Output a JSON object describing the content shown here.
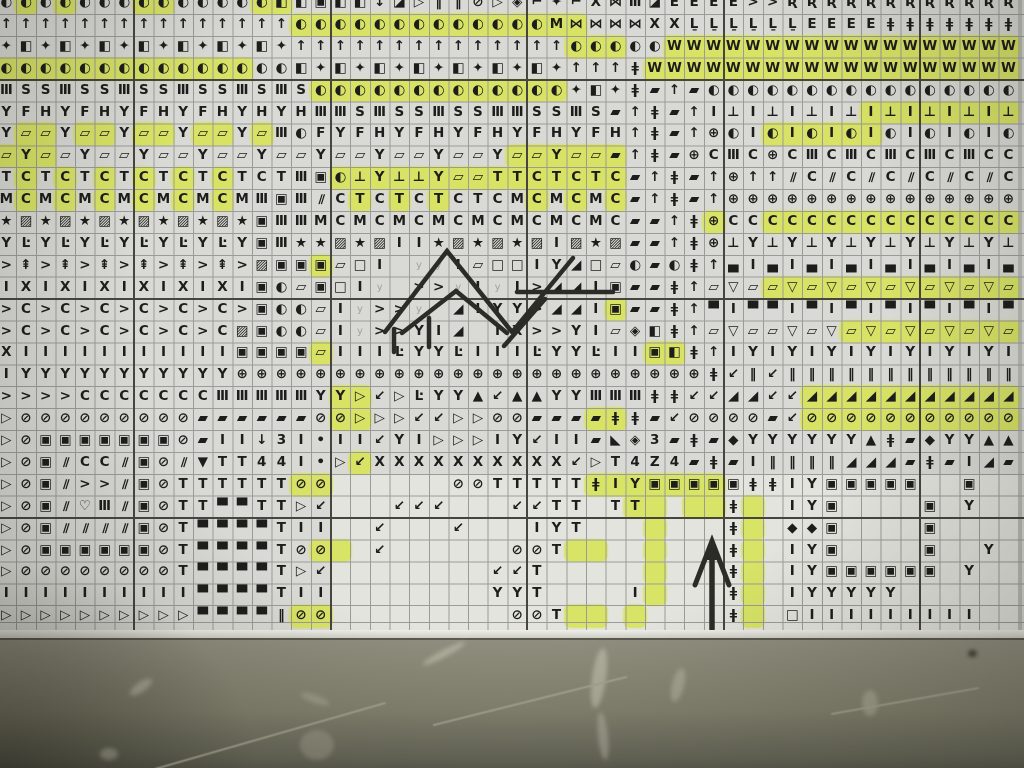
{
  "scene": {
    "description": "Photograph of a printed cross-stitch symbol chart with yellow highlighter marks, hand-drawn pen chevrons and a hand-drawn up arrow; gray wall below the paper edge"
  },
  "colors": {
    "paper": "#d9d9d5",
    "blank_paper": "#e4e4df",
    "thin_grid": "#9b9b97",
    "heavy_grid": "#46453f",
    "symbol_ink": "#1d1d1b",
    "highlighter": "#d8e45c",
    "pen_ink": "#2b2b27",
    "wall": "#83826f"
  },
  "symbol_legend": {
    "◐": "half-moon-circle-icon",
    "↑": "up-arrow-icon",
    "✦": "four-point-star-icon",
    "◧": "half-filled-square-icon",
    "▣": "square-in-square-icon",
    "◪": "diagonal-half-square-icon",
    "▱": "parallelogram-outline-icon",
    "▰": "parallelogram-filled-icon",
    "⊕": "circle-cross-icon",
    "⊘": "circle-slash-icon",
    "⊥": "tack-icon",
    "‖": "double-bar-icon",
    "★": "star-icon",
    "▨": "square-diagonal-icon",
    "Ŀ": "corner-dot-icon",
    "⇞": "barred-arrow-icon",
    "◈": "diamond-in-diamond-icon",
    "⌐": "flag-icon",
    "⋈": "bowtie-icon",
    "ǂ": "double-dagger-icon",
    "▽": "triangle-down-icon",
    "▷": "triangle-right-icon",
    "▲": "triangle-up-icon",
    "▀": "top-block-square-icon",
    "▄": "bottom-block-square-icon",
    "◢": "black-bean-diagonal-icon",
    "↙": "down-left-arrow-icon",
    "♡": "heart-icon",
    "◆": "black-diamond-icon",
    "∕∕": "double-slash-icon",
    "•": "dot-icon",
    "◣": "corner-triangle-icon"
  },
  "grid": {
    "cols": 52,
    "rows": 29,
    "cell_w": 19.65,
    "cell_h": 21.9,
    "origin_x": -3.5,
    "origin_y": -8,
    "heavy_cols": [
      7,
      17,
      27,
      37,
      47
    ],
    "heavy_rows": [
      4,
      14,
      24
    ],
    "rows_symbols": [
      "◐ ◐ ◐ ◐ ◐ ◐ ◐ ◐ ◐ ◐ ◐ ◐ ◐ ◐ ◧ ◧ ▣ ◧ ◧ ↓ ◪ ▷ ‖ ‖ ⊘ ▷ ◈ ⌐ ✦ ⌐ X ⋈ Ⅲ ◪ E E E E > > Ʀ Ʀ Ʀ Ʀ Ʀ Ʀ Ʀ Ʀ Ʀ Ʀ Ʀ Ʀ",
      "↑ ↑ ↑ ↑ ↑ ↑ ↑ ↑ ↑ ↑ ↑ ↑ ↑ ↑ ↑ ◐ ◐ ◐ ◐ ◐ ◐ ◐ ◐ ◐ ◐ ◐ ◐ ◐ M ⋈ ⋈ ⋈ ⋈ X X Ḻ Ḻ Ḻ Ḻ Ḻ Ḻ E E E E ǂ ǂ ǂ ǂ ǂ ǂ ǂ",
      "✦ ◧ ✦ ◧ ✦ ◧ ✦ ◧ ✦ ◧ ✦ ◧ ✦ ◧ ✦ ↑ ↑ ↑ ↑ ↑ ↑ ↑ ↑ ↑ ↑ ↑ ↑ ↑ ↑ ◐ ◐ ◐ ◐ ◐ W W W W W W W W W W W W W W W W W W",
      "◐ ◐ ◐ ◐ ◐ ◐ ◐ ◐ ◐ ◐ ◐ ◐ ◐ ◐ ◐ ◧ ✦ ◧ ✦ ◧ ✦ ◧ ✦ ◧ ✦ ◧ ✦ ◧ ✦ ↑ ↑ ↑ ǂ W W W W W W W W W W W W W W W W W W W",
      "Ⅲ S S Ⅲ S S Ⅲ S S Ⅲ S S Ⅲ S Ⅲ S ◐ ◐ ◐ ◐ ◐ ◐ ◐ ◐ ◐ ◐ ◐ ◐ ◐ ✦ ◧ ✦ ǂ ▰ ↑ ▰ ◐ ◐ ◐ ◐ ◐ ◐ ◐ ◐ ◐ ◐ ◐ ◐ ◐ ◐ ◐ ◐",
      "Y F H Y F H Y F H Y F H Y H Y H Ⅲ Ⅲ S Ⅲ S S Ⅲ S S Ⅲ Ⅲ S S Ⅲ S ▰ ↑ ǂ ▰ ↑ I ⊥ I ⊥ I ⊥ I ⊥ I ⊥ I ⊥ I ⊥ I ⊥",
      "Y ▱ ▱ Y ▱ ▱ Y ▱ ▱ Y ▱ ▱ Y ▱ Ⅲ ◐ F Y F H Y F H Y F H Y F H Y F H ↑ ǂ ▰ ↑ ⊕ ◐ I ◐ I ◐ I ◐ I ◐ I ◐ I ◐ I ◐",
      "▱ Y ▱ ▱ Y ▱ ▱ Y ▱ ▱ Y ▱ ▱ Y ▱ ▱ Y ▱ ▱ Y ▱ ▱ Y ▱ ▱ Y ▱ ▱ Y ▱ ▱ ▰ ↑ ǂ ▰ ⊕ C Ⅲ C ⊕ C Ⅲ C Ⅲ C Ⅲ C Ⅲ C Ⅲ C C",
      "T C T C T C T C T C T C T C T Ⅲ ▣ ◐ ⊥ Y ⊥ ⊥ Y ▱ ▱ T T C T C T C ▰ ↑ ǂ ▰ ↑ ⊕ ↑ ↑ ∕∕ C ∕∕ C ∕∕ C ∕∕ C ∕∕ C ∕∕ C",
      "M C M C M C M C M C M C M Ⅲ ▣ Ⅲ ∕∕ C T C T C T C T C M C M C M C ▰ ↑ ǂ ▰ ↑ ⊕ ⊕ ⊕ ⊕ ⊕ ⊕ ⊕ ⊕ ⊕ ⊕ ⊕ ⊕ ⊕ ⊕ ⊕",
      "★ ▨ ★ ▨ ★ ▨ ★ ▨ ★ ▨ ★ ▨ ★ ▣ Ⅲ Ⅲ M C M C M C M C M C M C M C M C ▰ ▰ ↑ ǂ ⊕ C C C C C C C C C C C C C C C",
      "Y Ŀ Y Ŀ Y Ŀ Y Ŀ Y Ŀ Y Ŀ Y ▣ Ⅲ ★ ★ ▨ ★ ▨ I I ★ ▨ ★ ▨ ★ ▨ I ▨ ★ ▨ ▰ ▰ ↑ ǂ ⊕ ⊥ Y ⊥ Y ⊥ Y ⊥ Y ⊥ Y ⊥ Y ⊥ Y ⊥",
      "> ⇞ > ⇞ > ⇞ > ⇞ > ⇞ > ⇞ > ▨ ▣ ▣ ▣ ▱ □ I . y y I ▱ □ □ I Y ◢ □ ▱ ◐ ▰ ◐ ǂ ↑ ▄ I ▄ I ▄ I ▄ I ▄ I ▄ I ▄ I ▄",
      "I X I X I X I X I X I X I ▣ ◐ ▱ ▣ □ I y . > > y I y I > ◢ ◢ I ▣ ▰ ▰ ǂ ↑ ▱ ▽ ▱ ▱ ▽ ▱ ▽ ▱ ▽ ▱ ▽ ▱ ▽ ▱ ▽ ▱",
      "> C > C > C > C > C > C > ▣ ◐ ◐ ▱ I y > > y . ◢ I Y Y > ◢ ◢ I ▣ ▰ ▰ ǂ ↑ ▀ I ▀ ▀ I ▀ I ▀ I ▀ I ▀ I ▀ I ▀",
      "> C > C > C > C > C > C ▨ ▣ ◐ ◐ ▱ I y > > Y I ◢ . I X > > Y I ▱ ◈ ◧ ǂ ↑ ▱ ▽ ▱ ▱ ▽ ▱ ▽ ▱ ▽ ▱ ▽ ▱ ▽ ▱ ▽ ▱",
      "X I I I I I I I I I I I ▣ ▣ ▣ ▣ ▱ I I I Ŀ Y Y Ŀ I I I Ŀ Y Y Ŀ I I ▣ ◧ ǂ ↑ I Y I Y I Y I Y I Y I Y I Y I",
      "I Y Y Y Y Y Y Y Y Y Y Y ⊕ ⊕ ⊕ ⊕ ⊕ ⊕ ⊕ ⊕ ⊕ ⊕ ⊕ ⊕ ⊕ ⊕ ⊕ ⊕ ⊕ ⊕ ⊕ ⊕ ⊕ ⊕ ⊕ ⊕ ǂ ↙ ‖ ↙ ‖ ‖ ‖ ‖ ‖ ‖ ‖ ‖ ‖ ‖ ‖ ‖",
      "> > > > C C C C C C C Ⅲ Ⅲ Ⅲ Ⅲ Ⅲ Y Y ▷ ↙ ▷ Ŀ Y Y ▲ ↙ ▲ ▲ Y Y Ⅲ Ⅲ Ⅲ ǂ ǂ ↙ ↙ ◢ ◢ ↙ ↙ ◢ ◢ ◢ ◢ ◢ ◢ ◢ ◢ ◢ ◢ ◢",
      "▷ ⊘ ⊘ ⊘ ⊘ ⊘ ⊘ ⊘ ⊘ ⊘ ▰ ▰ ▰ ▰ ▰ ▰ ⊘ ⊘ ▷ ▷ ▷ ↙ ↙ ▷ ▷ ⊘ ⊘ ▰ ▰ ▰ ▰ ǂ ǂ ▰ ↙ ⊘ ⊘ ⊘ ⊘ ▰ ↙ ⊘ ⊘ ⊘ ⊘ ⊘ ⊘ ⊘ ⊘ ⊘ ⊘ ⊘",
      "▷ ⊘ ▣ ▣ ▣ ▣ ▣ ▣ ▣ ⊘ ▰ I I ↓ 3 I • I I ↙ Y I ▷ ▷ ▷ I Y ↙ I I ▰ ◣ ◈ 3 ▰ ǂ ▰ ◆ Y Y Y Y Y Y ▲ ǂ ▰ ◆ Y Y ▲ ▲ ▲",
      "▷ ⊘ ▣ ∕∕ C C ∕∕ ▣ ⊘ ∕∕ ▼ T T 4 4 I • ▷ ↙ X X X X X X X X X X ↙ ▷ T 4 Z 4 ▰ ǂ ▰ I ‖ ‖ ‖ ‖ ◢ ◢ ◢ ▰ ǂ ▰ I ◢ ▰",
      "▷ ⊘ ▣ ∕∕ > > ∕∕ ▣ ⊘ T T T T T T ⊘ ⊘ . . . . . . ⊘ ⊘ T T T T T ǂ I Y ▣ ▣ ▣ ▣ ▣ ǂ ǂ I Y ▣ ▣ ▣ ▣ ▣ . . ▣ .",
      "▷ ⊘ ▣ ∕∕ ♡ Ⅲ ∕∕ ▣ ⊘ T T ▀ ▀ T T ▷ ↙ . . . ↙ ↙ ↙ . . . ↙ ↙ T T . T T . . . . ǂ . . I Y ▣ . . . . ▣ . Y . .",
      "▷ ⊘ ▣ ∕∕ ∕∕ ∕∕ ∕∕ ▣ ⊘ T ▀ ▀ ▀ ▀ T I I . . ↙ . . . ↙ . . . I Y T . . . . . . . ǂ . . ◆ ◆ ▣ . . . . ▣ . . . .",
      "▷ ⊘ ▣ ▣ ▣ ▣ ▣ ▣ ⊘ T ▀ ▀ ▀ ▀ T ⊘ ⊘ . . ↙ . . . . . . ⊘ ⊘ T . . . . . . . . ǂ . . I Y ▣ . . . . ▣ . . Y .",
      "▷ ⊘ ⊘ ⊘ ⊘ ⊘ ⊘ ⊘ ⊘ T ▀ ▀ ▀ ▀ T ▷ ↙ . . . . . . . . ↙ ↙ T . . . . . . . . . ǂ . . I Y ▣ ▣ ▣ ▣ ▣ ▣ . Y . .",
      "I I I I I I I I I I ▀ ▀ ▀ ▀ T I I . . . . . . . . Y Y T . . . . I . . . . ǂ . . I Y Y Y Y Y . . . . . .",
      "▷ ▷ ▷ ▷ ▷ ▷ ▷ ▷ ▷ ▷ ▀ ▀ ▀ ▀ ‖ ⊘ ⊘ . . . . . . . . . ⊘ ⊘ T . . . . . . . . ǂ . . □ I I I I I I I I I . ."
    ]
  },
  "highlights": [
    [
      0,
      1,
      1
    ],
    [
      0,
      3,
      3
    ],
    [
      0,
      7,
      8
    ],
    [
      0,
      13,
      14
    ],
    [
      1,
      15,
      25
    ],
    [
      1,
      26,
      29
    ],
    [
      2,
      29,
      31
    ],
    [
      2,
      34,
      38
    ],
    [
      2,
      39,
      51
    ],
    [
      3,
      0,
      12
    ],
    [
      3,
      33,
      38
    ],
    [
      3,
      39,
      51
    ],
    [
      4,
      16,
      28
    ],
    [
      5,
      44,
      51
    ],
    [
      6,
      1,
      2
    ],
    [
      6,
      4,
      5
    ],
    [
      6,
      7,
      8
    ],
    [
      6,
      10,
      11
    ],
    [
      6,
      13,
      13
    ],
    [
      6,
      39,
      44
    ],
    [
      7,
      0,
      2
    ],
    [
      7,
      26,
      31
    ],
    [
      8,
      1,
      1
    ],
    [
      8,
      3,
      3
    ],
    [
      8,
      5,
      5
    ],
    [
      8,
      7,
      7
    ],
    [
      8,
      9,
      9
    ],
    [
      8,
      11,
      11
    ],
    [
      8,
      17,
      25
    ],
    [
      8,
      26,
      31
    ],
    [
      9,
      1,
      1
    ],
    [
      9,
      3,
      3
    ],
    [
      9,
      5,
      5
    ],
    [
      9,
      7,
      7
    ],
    [
      9,
      9,
      9
    ],
    [
      9,
      11,
      11
    ],
    [
      9,
      18,
      18
    ],
    [
      9,
      20,
      20
    ],
    [
      9,
      22,
      22
    ],
    [
      9,
      27,
      27
    ],
    [
      9,
      29,
      29
    ],
    [
      9,
      31,
      31
    ],
    [
      10,
      36,
      36
    ],
    [
      10,
      39,
      51
    ],
    [
      12,
      16,
      16
    ],
    [
      13,
      39,
      51
    ],
    [
      14,
      31,
      31
    ],
    [
      15,
      43,
      51
    ],
    [
      16,
      16,
      16
    ],
    [
      16,
      33,
      34
    ],
    [
      18,
      17,
      18
    ],
    [
      18,
      41,
      51
    ],
    [
      19,
      17,
      18
    ],
    [
      19,
      30,
      31
    ],
    [
      19,
      41,
      51
    ],
    [
      21,
      18,
      18
    ],
    [
      22,
      15,
      16
    ],
    [
      22,
      30,
      36
    ],
    [
      23,
      32,
      33
    ],
    [
      23,
      35,
      36
    ],
    [
      23,
      38,
      38
    ],
    [
      24,
      33,
      33
    ],
    [
      24,
      38,
      38
    ],
    [
      25,
      16,
      17
    ],
    [
      25,
      29,
      30
    ],
    [
      25,
      33,
      33
    ],
    [
      25,
      38,
      38
    ],
    [
      26,
      33,
      33
    ],
    [
      26,
      38,
      38
    ],
    [
      27,
      33,
      33
    ],
    [
      27,
      38,
      38
    ],
    [
      28,
      15,
      16
    ],
    [
      28,
      29,
      30
    ],
    [
      28,
      32,
      32
    ],
    [
      28,
      38,
      38
    ]
  ],
  "pen_marks": {
    "strokes": [
      [
        [
          385,
          332
        ],
        [
          447,
          251
        ],
        [
          512,
          332
        ]
      ],
      [
        [
          402,
          333
        ],
        [
          456,
          291
        ],
        [
          507,
          333
        ]
      ],
      [
        [
          394,
          329
        ],
        [
          394,
          352
        ]
      ],
      [
        [
          429,
          318
        ],
        [
          429,
          347
        ]
      ],
      [
        [
          573,
          258
        ],
        [
          513,
          331
        ]
      ],
      [
        [
          545,
          299
        ],
        [
          504,
          346
        ]
      ],
      [
        [
          517,
          292
        ],
        [
          613,
          292
        ]
      ]
    ],
    "arrow": {
      "shaft": [
        [
          712,
          629
        ],
        [
          712,
          556
        ]
      ],
      "head": [
        [
          695,
          585
        ],
        [
          712,
          541
        ],
        [
          729,
          585
        ]
      ]
    }
  },
  "wall": {
    "scuffs": [
      {
        "x": 128,
        "y": 682,
        "w": 26,
        "h": 10,
        "rot": -35,
        "c": "rgba(190,188,170,0.55)"
      },
      {
        "x": 100,
        "y": 748,
        "w": 18,
        "h": 12,
        "rot": 0,
        "c": "rgba(185,183,165,0.5)"
      },
      {
        "x": 300,
        "y": 695,
        "w": 30,
        "h": 8,
        "rot": 20,
        "c": "rgba(180,178,160,0.45)"
      },
      {
        "x": 420,
        "y": 650,
        "w": 48,
        "h": 7,
        "rot": -28,
        "c": "rgba(195,193,175,0.6)"
      },
      {
        "x": 592,
        "y": 648,
        "w": 14,
        "h": 60,
        "rot": 8,
        "c": "rgba(196,194,176,0.6)"
      },
      {
        "x": 598,
        "y": 712,
        "w": 10,
        "h": 48,
        "rot": -6,
        "c": "rgba(188,186,168,0.5)"
      },
      {
        "x": 672,
        "y": 668,
        "w": 12,
        "h": 34,
        "rot": 14,
        "c": "rgba(190,188,170,0.5)"
      },
      {
        "x": 862,
        "y": 690,
        "w": 16,
        "h": 26,
        "rot": 0,
        "c": "rgba(186,184,166,0.5)"
      },
      {
        "x": 968,
        "y": 650,
        "w": 9,
        "h": 7,
        "rot": 0,
        "c": "rgba(45,45,36,0.8)"
      },
      {
        "x": 300,
        "y": 730,
        "w": 34,
        "h": 30,
        "rot": 0,
        "c": "rgba(175,173,155,0.4)"
      }
    ],
    "scratches": [
      {
        "x": 150,
        "y": 735,
        "w": 240,
        "rot": -16
      },
      {
        "x": 430,
        "y": 700,
        "w": 200,
        "rot": -14
      },
      {
        "x": 830,
        "y": 700,
        "w": 150,
        "rot": -10
      }
    ]
  }
}
